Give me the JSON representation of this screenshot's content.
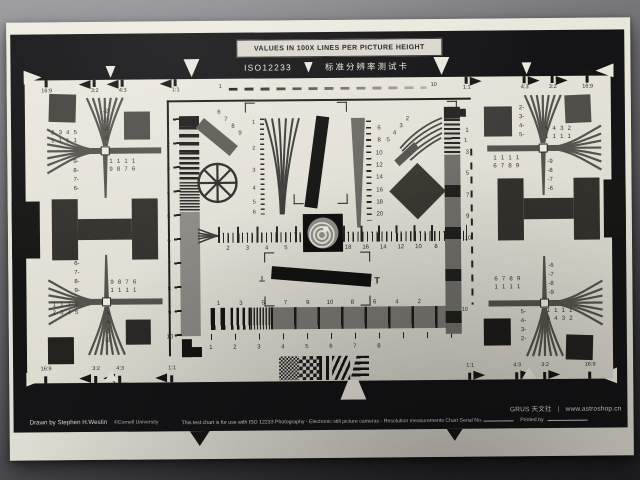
{
  "chart": {
    "header": {
      "banner": "VALUES IN 100X LINES PER PICTURE HEIGHT",
      "title": "ISO12233",
      "title_cn": "标准分辨率测试卡"
    },
    "footer": {
      "brand": "GRUS 天文社",
      "separator": "|",
      "url": "www.astroshop.cn",
      "credit": "Drawn by Stephen H.Westin",
      "credit_org": "©Cornell University",
      "usage": "This test chart is for use with ISO 12233 Photography - Electronic still picture cameras - Resolution measurements Chart Serial No.",
      "printed_by": "Printed by"
    },
    "aspect_top": [
      "16:9",
      "3:2",
      "4:3",
      "1:1",
      "1:1",
      "4:3",
      "3:2",
      "16:9"
    ],
    "aspect_bottom": [
      "16:9",
      "3:2",
      "4:3",
      "1:1",
      "1:1",
      "4:3",
      "3:2",
      "16:9"
    ],
    "corners": {
      "tl": {
        "edge_col": "-2\n-3\n-4\n-5",
        "outer_rows": "2 3 4 5\n1 1 1 1",
        "mid_col": "9-\n8-\n7-\n6-",
        "inner_rows": "1 1 1 1\n9 8 7 6"
      },
      "bl": {
        "edge_col": "-5\n-4\n-3\n-2",
        "outer_rows": "1 1 1 1\n2 3 4 5",
        "mid_col": "6-\n7-\n8-\n9-",
        "inner_rows": "9 8 7 6\n1 1 1 1"
      },
      "tr": {
        "edge_col": "2-\n3-\n4-\n5-",
        "outer_rows": "5 4 3 2\n1 1 1 1",
        "mid_col": "-9\n-8\n-7\n-6",
        "inner_rows": "1 1 1 1\n6 7 8 9"
      },
      "br": {
        "edge_col": "5-\n4-\n3-\n2-",
        "outer_rows": "1 1 1 1\n5 4 3 2",
        "mid_col": "-6\n-7\n-8\n-9",
        "inner_rows": "6 7 8 9\n1 1 1 1"
      }
    },
    "scales": {
      "top_dashed_left": "1",
      "top_dashed_right": "10",
      "left_ruler": [
        "1",
        "2",
        "3",
        "4",
        "5",
        "6",
        "7",
        "8",
        "9",
        "10"
      ],
      "slant_bar": [
        "6",
        "7",
        "8",
        "9"
      ],
      "center_wedge": [
        "1",
        "2",
        "3",
        "4",
        "5",
        "6"
      ],
      "right_wedge": [
        "6",
        "8",
        "10",
        "12",
        "14",
        "16",
        "18",
        "20"
      ],
      "right_strip": [
        "1",
        "3",
        "5",
        "7",
        "9",
        "10"
      ],
      "right_dashed_top": "1",
      "right_dashed_bottom": "10",
      "diag_fan": [
        "5",
        "4",
        "3",
        "2"
      ],
      "hruler_left": [
        "2",
        "3",
        "4",
        "5"
      ],
      "hruler_right": [
        "18",
        "16",
        "14",
        "12",
        "10",
        "8",
        "6"
      ],
      "tbar_left": "⊥",
      "tbar_right": "T",
      "sweep_top": [
        "1",
        "3",
        "5",
        "7",
        "9",
        "10",
        "8",
        "6",
        "4",
        "2"
      ],
      "sweep_bottom": [
        "1",
        "2",
        "3",
        "4",
        "5",
        "6",
        "7",
        "8"
      ]
    }
  }
}
